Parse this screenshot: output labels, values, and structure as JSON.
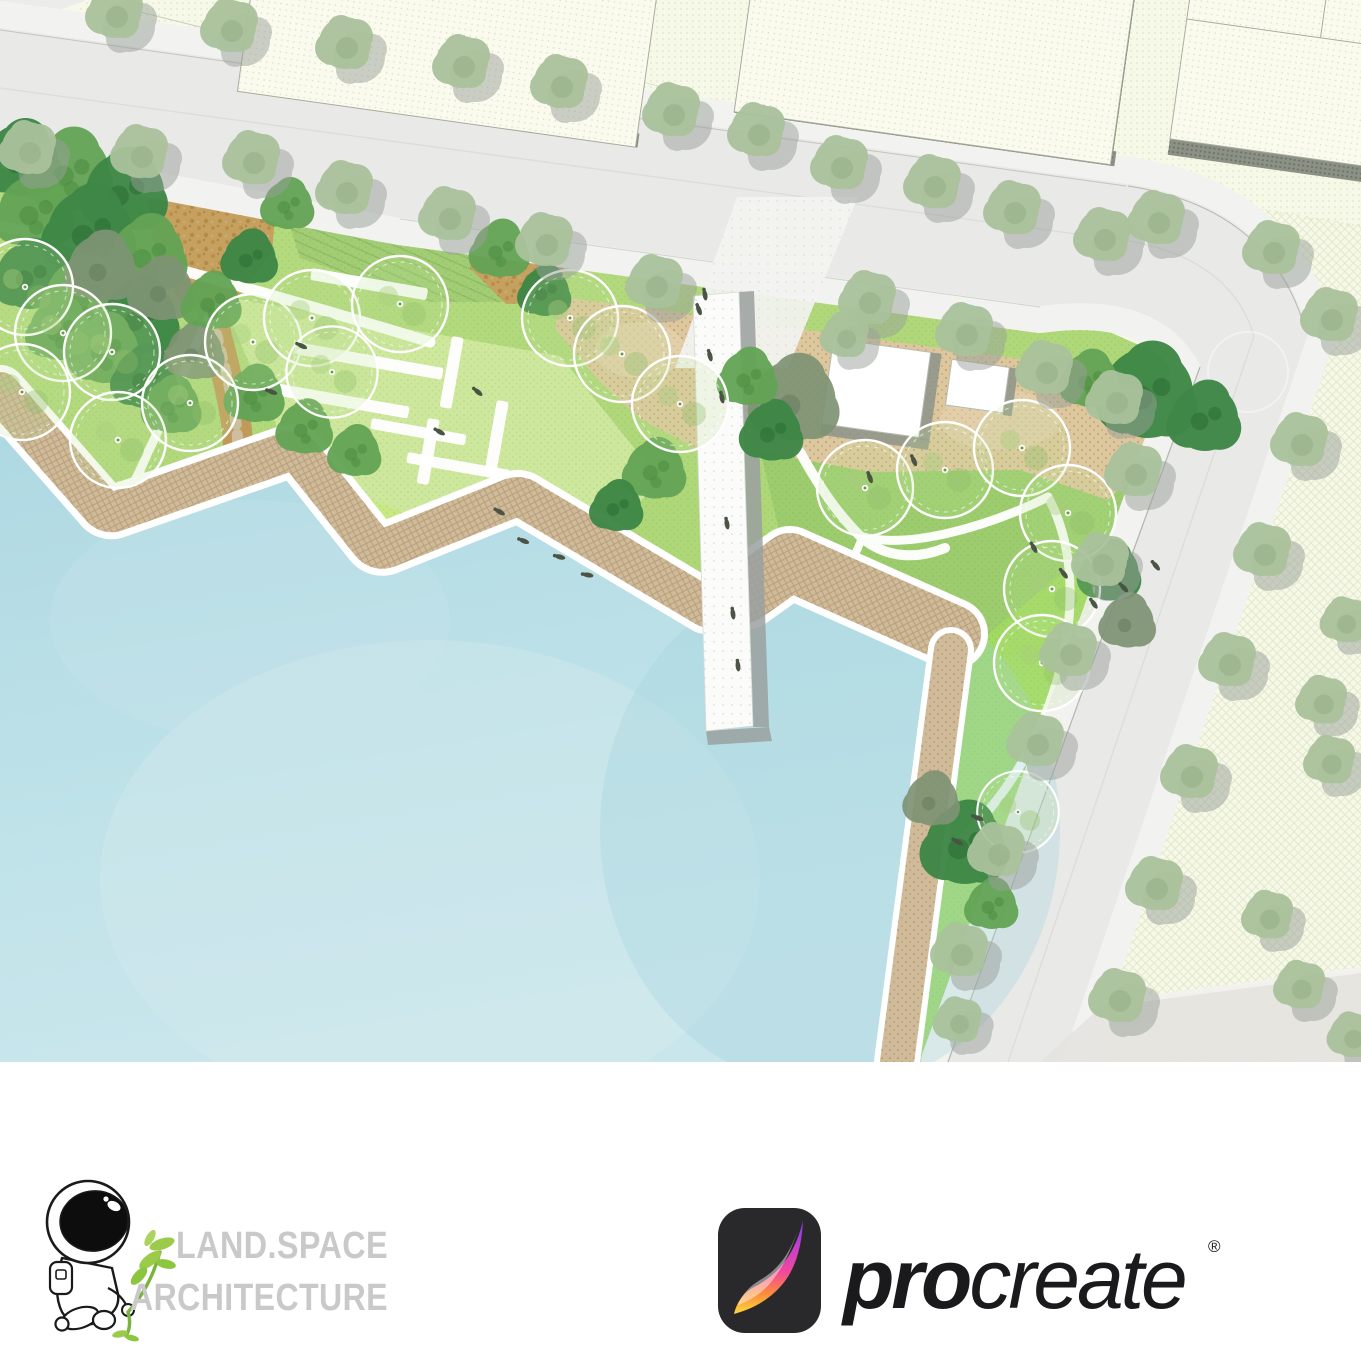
{
  "meta": {
    "description": "Waterfront park landscape site plan artwork"
  },
  "palette": {
    "water": "#b3dae4",
    "water_light": "#cfe9ee",
    "water_deep": "#9ccfdb",
    "lawn": "#b2d97c",
    "lawn_light": "#d0e9a0",
    "lawn_bright": "#a0da62",
    "lawn_olive": "#9bcb6d",
    "road": "#e9e9e7",
    "sidewalk": "#f2f2f0",
    "boardwalk": "#cfba9a",
    "plaza": "#dcc79e",
    "gravel": "#c6a05f",
    "parcel": "#f6f8e8",
    "building": "#fafbee",
    "building_shadow": "#8b9184",
    "pier": "#fbfbf9",
    "pier_shadow": "#9aa0a0",
    "tree_street": "#aac29c",
    "tree_street_shadow": "#9aa19a",
    "tree_dark": "#3e8746",
    "tree_mid": "#63a455",
    "tree_gray": "#7e9374",
    "canopy_ring": "#ffffff",
    "figure": "#4b5345"
  },
  "plan": {
    "trees": {
      "street": [
        [
          115,
          12
        ],
        [
          230,
          26
        ],
        [
          345,
          43
        ],
        [
          462,
          62
        ],
        [
          560,
          82
        ],
        [
          672,
          110
        ],
        [
          757,
          130
        ],
        [
          840,
          163
        ],
        [
          933,
          182
        ],
        [
          1013,
          208
        ],
        [
          1103,
          235
        ],
        [
          1157,
          218
        ],
        [
          1272,
          248
        ],
        [
          1330,
          315
        ],
        [
          28,
          148
        ],
        [
          140,
          152
        ],
        [
          252,
          158
        ],
        [
          345,
          188
        ],
        [
          448,
          214
        ],
        [
          545,
          240
        ],
        [
          655,
          282
        ],
        [
          868,
          298
        ],
        [
          845,
          335,
          0.85
        ],
        [
          965,
          330
        ],
        [
          1045,
          368
        ],
        [
          1115,
          398
        ],
        [
          1134,
          470
        ],
        [
          1101,
          560
        ],
        [
          1069,
          650
        ],
        [
          1036,
          740
        ],
        [
          997,
          850
        ],
        [
          960,
          950
        ],
        [
          958,
          1020,
          0.85
        ],
        [
          1300,
          440
        ],
        [
          1263,
          550
        ],
        [
          1228,
          660
        ],
        [
          1190,
          772
        ],
        [
          1155,
          884
        ],
        [
          1118,
          996
        ],
        [
          1345,
          620,
          0.85
        ],
        [
          1322,
          700,
          0.9
        ],
        [
          1330,
          760,
          0.9
        ],
        [
          1268,
          915,
          0.9
        ],
        [
          1300,
          985,
          0.9
        ],
        [
          1352,
          1035,
          0.85
        ]
      ],
      "canopy": [
        [
          25,
          287
        ],
        [
          63,
          333
        ],
        [
          112,
          352
        ],
        [
          22,
          392
        ],
        [
          118,
          440
        ],
        [
          190,
          403
        ],
        [
          253,
          342
        ],
        [
          312,
          318
        ],
        [
          332,
          372,
          0.95
        ],
        [
          400,
          304
        ],
        [
          570,
          318
        ],
        [
          622,
          354
        ],
        [
          680,
          404
        ],
        [
          865,
          488
        ],
        [
          945,
          470
        ],
        [
          1022,
          448
        ],
        [
          1068,
          513
        ],
        [
          1052,
          589
        ],
        [
          1042,
          663
        ],
        [
          1018,
          812,
          0.85
        ]
      ],
      "spiky": [
        [
          220,
          231,
          0.75
        ],
        [
          233,
          277,
          0.8
        ],
        [
          192,
          436,
          0.75
        ],
        [
          383,
          466,
          0.8
        ],
        [
          447,
          501,
          0.75
        ],
        [
          520,
          456,
          0.75
        ],
        [
          583,
          531,
          0.75
        ],
        [
          528,
          398,
          0.8
        ],
        [
          620,
          417,
          0.75
        ],
        [
          650,
          471,
          0.75
        ],
        [
          712,
          494,
          0.8
        ],
        [
          733,
          441,
          0.75
        ],
        [
          778,
          478,
          0.85
        ],
        [
          715,
          561,
          0.75
        ],
        [
          852,
          521,
          0.8
        ],
        [
          873,
          569,
          0.75
        ],
        [
          985,
          523,
          0.8
        ],
        [
          1003,
          561,
          0.75
        ],
        [
          777,
          349,
          0.95
        ],
        [
          1091,
          424,
          0.8
        ],
        [
          1138,
          451,
          0.75
        ],
        [
          1193,
          464,
          0.7
        ],
        [
          1018,
          814,
          0.9
        ],
        [
          974,
          898,
          0.85
        ]
      ],
      "blob": [
        [
          22,
          160,
          1.2,
          "d"
        ],
        [
          70,
          172,
          1.3,
          "m"
        ],
        [
          125,
          192,
          1.3,
          "d"
        ],
        [
          35,
          212,
          1.2,
          "m"
        ],
        [
          90,
          232,
          1.4,
          "d"
        ],
        [
          148,
          255,
          1.2,
          "m"
        ],
        [
          30,
          276,
          1.1,
          "d"
        ],
        [
          85,
          298,
          1.3,
          "m"
        ],
        [
          140,
          318,
          1.2,
          "d"
        ],
        [
          102,
          268,
          1.1,
          "g"
        ],
        [
          162,
          290,
          1.0,
          "g"
        ],
        [
          105,
          350,
          1.1,
          "m"
        ],
        [
          145,
          378,
          1.0,
          "d"
        ],
        [
          172,
          406,
          0.9,
          "m"
        ],
        [
          60,
          330,
          1.0,
          "m"
        ],
        [
          195,
          352,
          0.9,
          "g"
        ],
        [
          212,
          302,
          0.9,
          "m"
        ],
        [
          250,
          258,
          0.85,
          "d"
        ],
        [
          255,
          395,
          0.9,
          "m"
        ],
        [
          305,
          428,
          0.85,
          "m"
        ],
        [
          355,
          452,
          0.8,
          "m"
        ],
        [
          288,
          205,
          0.8,
          "m"
        ],
        [
          500,
          250,
          0.9,
          "m"
        ],
        [
          545,
          292,
          0.8,
          "d"
        ],
        [
          655,
          470,
          0.95,
          "m"
        ],
        [
          617,
          507,
          0.8,
          "d"
        ],
        [
          795,
          400,
          1.35,
          "g"
        ],
        [
          772,
          432,
          0.95,
          "d"
        ],
        [
          748,
          378,
          0.9,
          "m"
        ],
        [
          1148,
          393,
          1.5,
          "d"
        ],
        [
          1205,
          418,
          1.1,
          "d"
        ],
        [
          1090,
          380,
          0.9,
          "m"
        ],
        [
          1110,
          572,
          0.95,
          "d"
        ],
        [
          1128,
          622,
          0.85,
          "g"
        ],
        [
          965,
          845,
          1.3,
          "d"
        ],
        [
          932,
          800,
          0.85,
          "g"
        ],
        [
          992,
          905,
          0.8,
          "m"
        ]
      ]
    },
    "benches": [
      [
        312,
        268,
        118,
        12
      ],
      [
        296,
        342,
        150,
        12
      ],
      [
        258,
        380,
        154,
        12
      ],
      [
        372,
        418,
        96,
        11
      ],
      [
        408,
        452,
        104,
        11
      ],
      [
        462,
        488,
        56,
        11
      ],
      [
        452,
        336,
        12,
        72
      ],
      [
        497,
        400,
        12,
        74
      ],
      [
        428,
        418,
        12,
        66
      ]
    ],
    "figures": [
      [
        705,
        295,
        80
      ],
      [
        699,
        310,
        70
      ],
      [
        710,
        356,
        75
      ],
      [
        722,
        398,
        78
      ],
      [
        727,
        524,
        80
      ],
      [
        733,
        614,
        82
      ],
      [
        738,
        666,
        84
      ],
      [
        500,
        512,
        30
      ],
      [
        524,
        541,
        22
      ],
      [
        560,
        557,
        15
      ],
      [
        588,
        575,
        10
      ],
      [
        478,
        392,
        40
      ],
      [
        440,
        432,
        30
      ],
      [
        302,
        346,
        25
      ],
      [
        272,
        392,
        20
      ],
      [
        1034,
        548,
        60
      ],
      [
        1064,
        574,
        52
      ],
      [
        1094,
        604,
        55
      ],
      [
        1124,
        588,
        46
      ],
      [
        1156,
        566,
        50
      ],
      [
        958,
        842,
        30
      ],
      [
        978,
        818,
        22
      ],
      [
        870,
        478,
        70
      ],
      [
        914,
        461,
        66
      ]
    ]
  },
  "footer": {
    "studio": {
      "line1": "LAND.SPACE",
      "line2": "ARCHITECTURE"
    },
    "procreate": {
      "pro": "pro",
      "create": "create",
      "registered": "®"
    }
  }
}
